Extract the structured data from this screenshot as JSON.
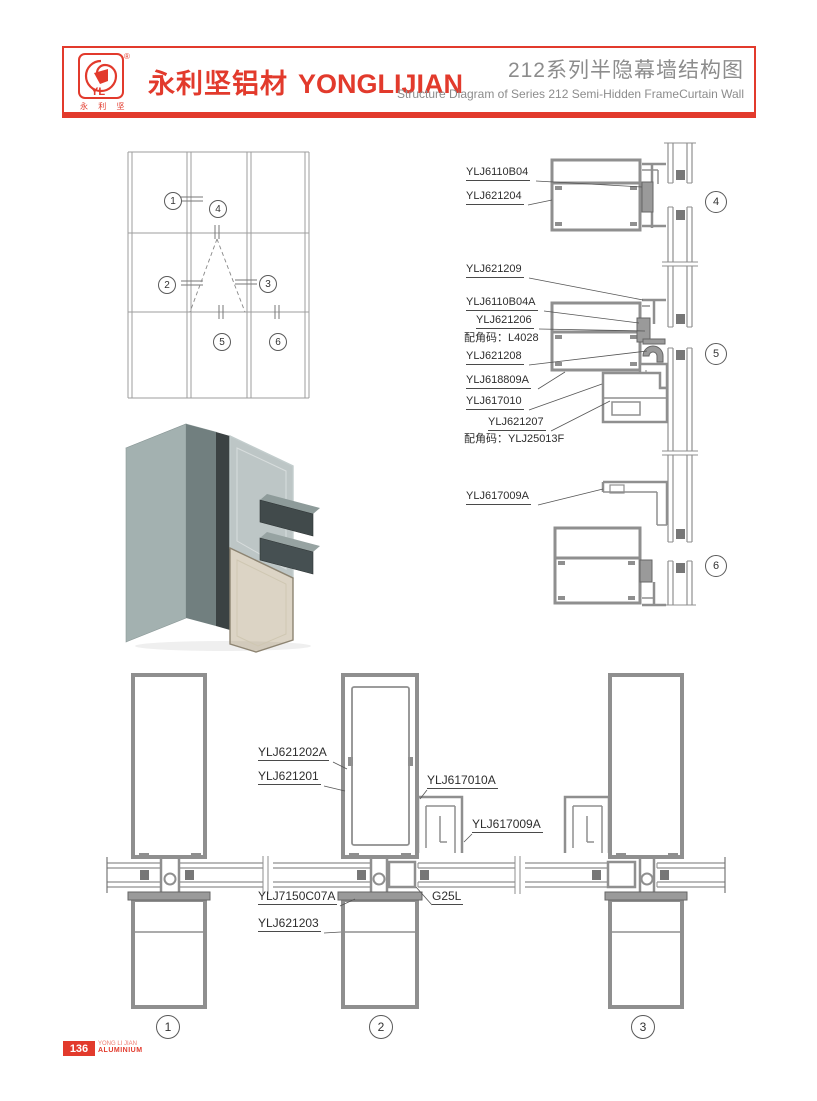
{
  "header": {
    "brand_cn": "永利坚铝材",
    "brand_en": "YONGLIJIAN",
    "title_cn": "212系列半隐幕墙结构图",
    "title_en": "Structure Diagram of Series 212 Semi-Hidden FrameCurtain Wall",
    "logo": {
      "monogram": "YL",
      "registered": "®",
      "logo_chars": "永 利 坚"
    }
  },
  "elevation": {
    "callouts": [
      "1",
      "2",
      "3",
      "4",
      "5",
      "6"
    ]
  },
  "right_details": {
    "labels": [
      {
        "text": "YLJ6110B04"
      },
      {
        "text": "YLJ621204"
      },
      {
        "text": "YLJ621209"
      },
      {
        "text": "YLJ6110B04A"
      },
      {
        "text": "YLJ621206"
      },
      {
        "text": "配角码：L4028"
      },
      {
        "text": "YLJ621208"
      },
      {
        "text": "YLJ618809A"
      },
      {
        "text": "YLJ617010"
      },
      {
        "text": "YLJ621207"
      },
      {
        "text": "配角码：YLJ25013F"
      },
      {
        "text": "YLJ617009A"
      }
    ],
    "callouts": [
      "4",
      "5",
      "6"
    ]
  },
  "bottom_details": {
    "labels": [
      {
        "text": "YLJ621202A"
      },
      {
        "text": "YLJ621201"
      },
      {
        "text": "YLJ617010A"
      },
      {
        "text": "YLJ617009A"
      },
      {
        "text": "YLJ7150C07A"
      },
      {
        "text": "G25L"
      },
      {
        "text": "YLJ621203"
      }
    ],
    "callouts": [
      "1",
      "2",
      "3"
    ]
  },
  "footer": {
    "page_number": "136",
    "brand_line1": "YONG LI JIAN",
    "brand_line2": "ALUMINIUM"
  },
  "colors": {
    "brand_red": "#E23A2C",
    "profile_gray": "#8f8f8f",
    "title_gray": "#8c8c8c"
  }
}
